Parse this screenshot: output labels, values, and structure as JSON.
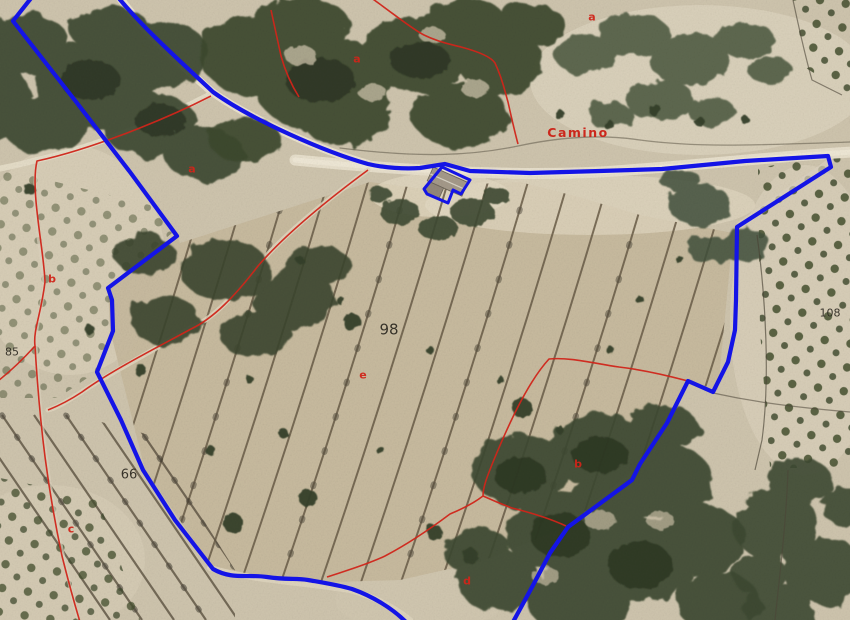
{
  "map": {
    "type": "aerial-cadastral-orthophoto",
    "colors": {
      "parcel_boundary_blue": "#1414e6",
      "subparcel_boundary_red": "#d0251a",
      "parcel_number_color": "#2c2820",
      "letter_color": "#d0251a",
      "road_label_color": "#cc2015"
    },
    "labels": {
      "parcel_numbers": [
        {
          "text": "98",
          "x": 389,
          "y": 330,
          "size": 15
        },
        {
          "text": "66",
          "x": 129,
          "y": 475,
          "size": 13
        },
        {
          "text": "85",
          "x": 12,
          "y": 352,
          "size": 11
        },
        {
          "text": "108",
          "x": 830,
          "y": 313,
          "size": 11
        }
      ],
      "subparcel_letters": [
        {
          "text": "a",
          "x": 192,
          "y": 169
        },
        {
          "text": "a",
          "x": 357,
          "y": 59
        },
        {
          "text": "a",
          "x": 592,
          "y": 17
        },
        {
          "text": "b",
          "x": 52,
          "y": 279
        },
        {
          "text": "e",
          "x": 363,
          "y": 375
        },
        {
          "text": "b",
          "x": 578,
          "y": 464
        },
        {
          "text": "c",
          "x": 71,
          "y": 529
        },
        {
          "text": "d",
          "x": 467,
          "y": 581
        }
      ],
      "road_label": {
        "text": "Camino",
        "x": 578,
        "y": 133
      }
    }
  }
}
